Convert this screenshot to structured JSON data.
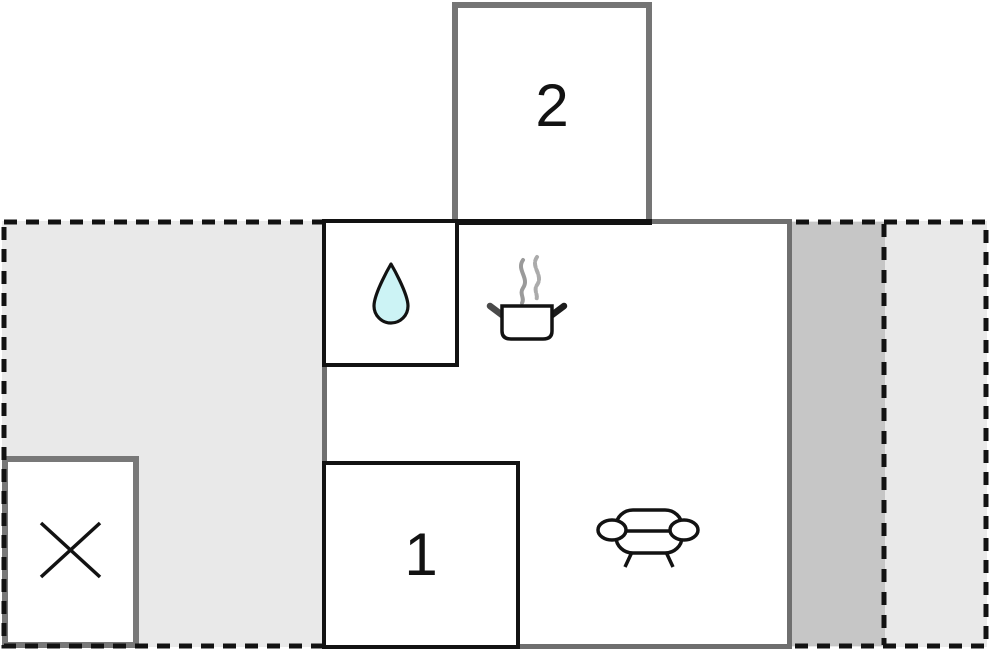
{
  "floor_plan": {
    "description": "holiday-home floor plan with numbered rooms, terrace plot outline and furnishing icons",
    "rooms": {
      "room1": {
        "label": "1"
      },
      "room2": {
        "label": "2"
      }
    },
    "icons": {
      "bathroom": "water-drop-icon",
      "kitchen": "cooking-pot-with-steam-icon",
      "living_area": "sofa-icon",
      "annex": "cross-icon"
    },
    "colors": {
      "plot_fill": "#e9e9e9",
      "strip_fill": "#c6c6c6",
      "outer_wall_gray": "#6f6f6f",
      "annex_wall_gray": "#787878",
      "inner_wall_black": "#121212",
      "dash_line": "#121212",
      "water_drop_fill": "#ccf3f5",
      "steam_gray": "#9a9a9a",
      "room_fill": "#ffffff"
    }
  }
}
